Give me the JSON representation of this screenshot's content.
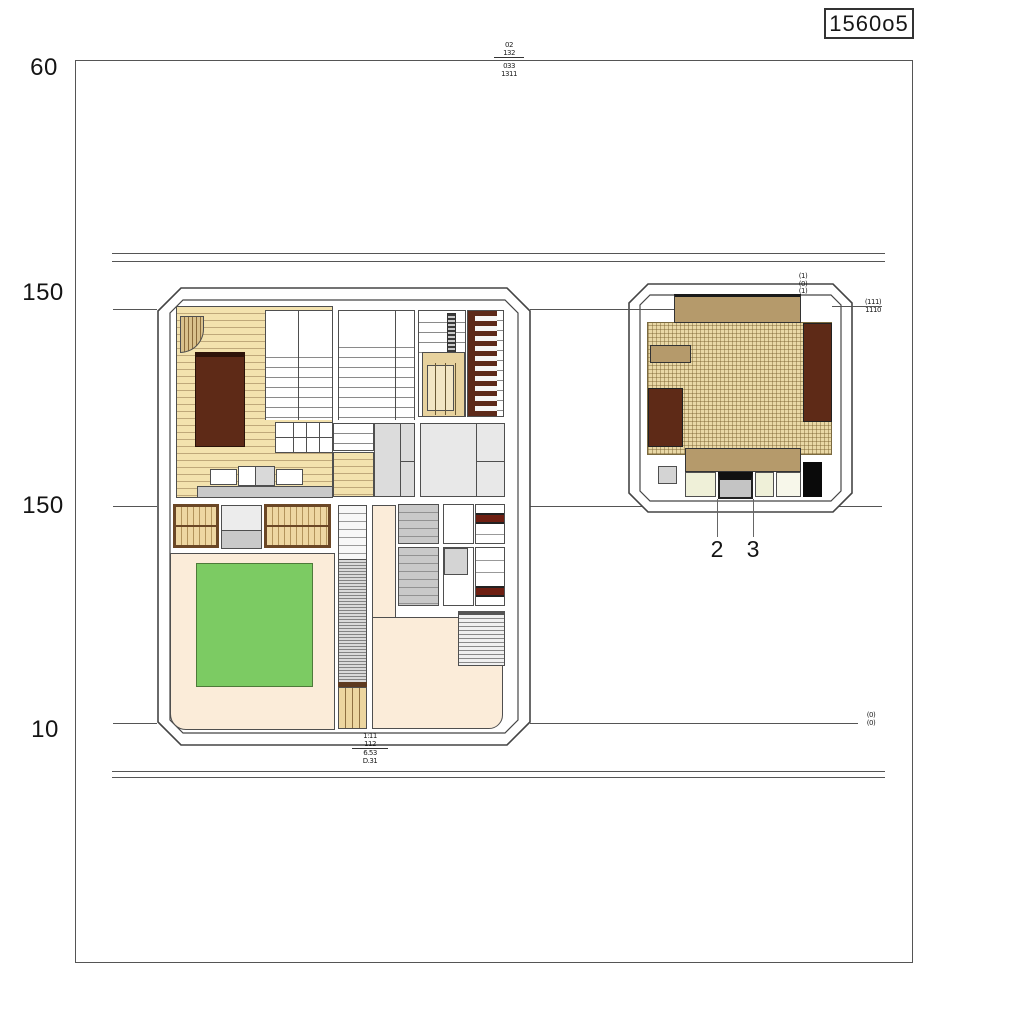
{
  "drawing": {
    "title_box": "1560o5",
    "left_dimension_labels": [
      "60",
      "150",
      "150",
      "10"
    ],
    "small_plan_callouts": [
      "2",
      "3"
    ],
    "tiny_annotations": {
      "top_center_upper": [
        "02",
        "132"
      ],
      "top_center_lower": [
        "033",
        "1311"
      ],
      "small_plan_top_corner": [
        "(1)",
        "(0)",
        "(1)"
      ],
      "right_edge_mid": [
        "(111)",
        "1110"
      ],
      "right_edge_low": [
        "(0)",
        "(0)"
      ],
      "below_big_plan_upper": [
        "1:11",
        "112"
      ],
      "below_big_plan_lower": [
        "6.53",
        "D.31"
      ]
    },
    "colors": {
      "wood_floor": "#f3e2ae",
      "dark_brown": "#5e2a17",
      "tan_furniture": "#b59a6b",
      "tatami_floor": "#e9d8a6",
      "green_mat": "#7ccb63",
      "peach_floor": "#fbecd9",
      "cream_cell": "#eff0d8",
      "black_item": "#0a0a0a",
      "line_color": "#555555"
    }
  }
}
